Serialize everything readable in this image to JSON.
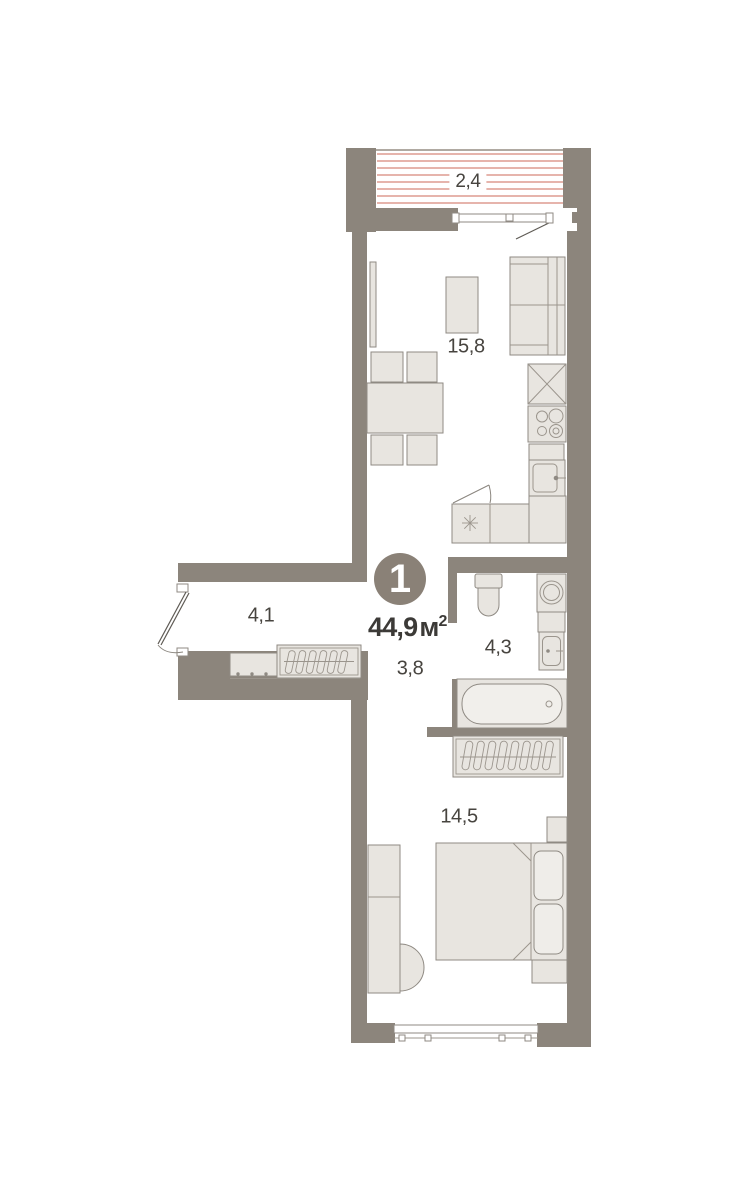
{
  "plan": {
    "unit_number": "1",
    "total_area": {
      "value": "44,9",
      "unit": "м",
      "sup": "2"
    },
    "rooms": [
      {
        "name": "balcony",
        "area": "2,4"
      },
      {
        "name": "living-kitchen",
        "area": "15,8"
      },
      {
        "name": "hallway",
        "area": "4,1"
      },
      {
        "name": "corridor",
        "area": "3,8"
      },
      {
        "name": "bathroom",
        "area": "4,3"
      },
      {
        "name": "bedroom",
        "area": "14,5"
      }
    ],
    "colors": {
      "wall": "#8C857C",
      "furniture_fill": "#E8E5E0",
      "furniture_stroke": "#8F8A83",
      "detail_stroke": "#9B958D",
      "stripe": "#DD9B90",
      "text_dark": "#3C3A37",
      "text_room": "#47443F",
      "badge": "#8A8177",
      "background": "#FFFFFF"
    }
  }
}
